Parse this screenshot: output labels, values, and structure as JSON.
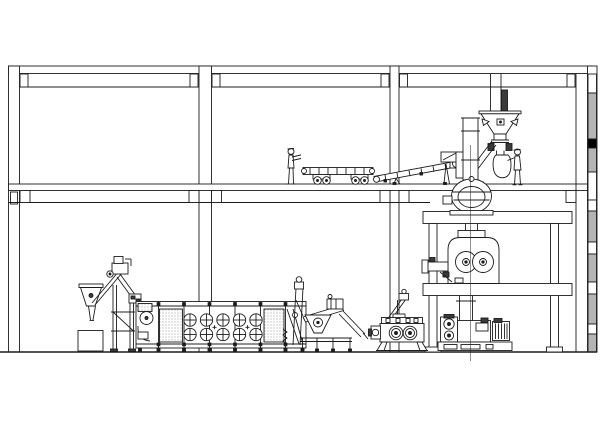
{
  "drawing": {
    "background": "#ffffff",
    "line_color": "#1c1c1c",
    "dark_fill": "#3a3a3a",
    "hatch_gray": "#b4b4b4",
    "marker_black": "#000000",
    "floors": 2,
    "workers": 2,
    "platform_levels": 2,
    "dryer_fan_grid": {
      "rows": 2,
      "columns": 5
    },
    "mill_rolls": 2,
    "press_rolls": 2
  }
}
